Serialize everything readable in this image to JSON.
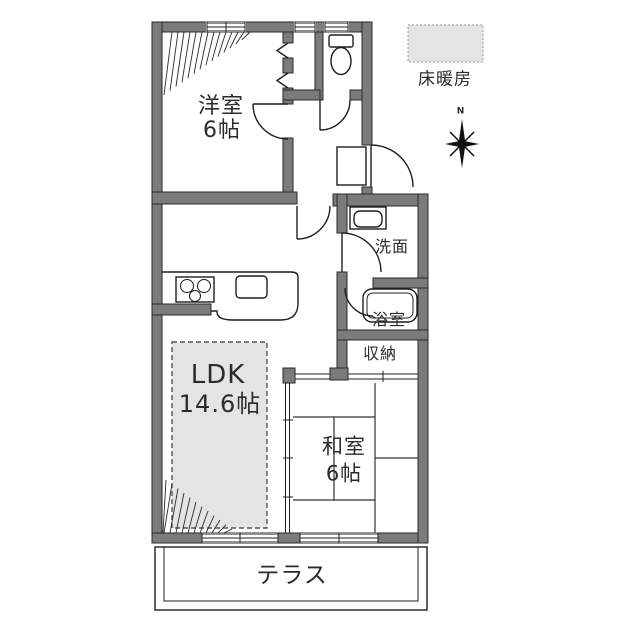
{
  "rooms": {
    "western": {
      "name": "洋室",
      "size": "6帖"
    },
    "ldk": {
      "name": "LDK",
      "size": "14.6帖"
    },
    "japanese": {
      "name": "和室",
      "size": "6帖"
    },
    "washroom": {
      "name": "洗面"
    },
    "bathroom": {
      "name": "浴室"
    },
    "storage": {
      "name": "収納"
    },
    "terrace": {
      "name": "テラス"
    }
  },
  "legend": {
    "floor_heating": "床暖房"
  },
  "compass": {
    "north": "N"
  },
  "colors": {
    "wall": "#7b7b7b",
    "line": "#1f1f1f",
    "floor_heating_fill": "#e4e4e4",
    "background": "#ffffff"
  }
}
